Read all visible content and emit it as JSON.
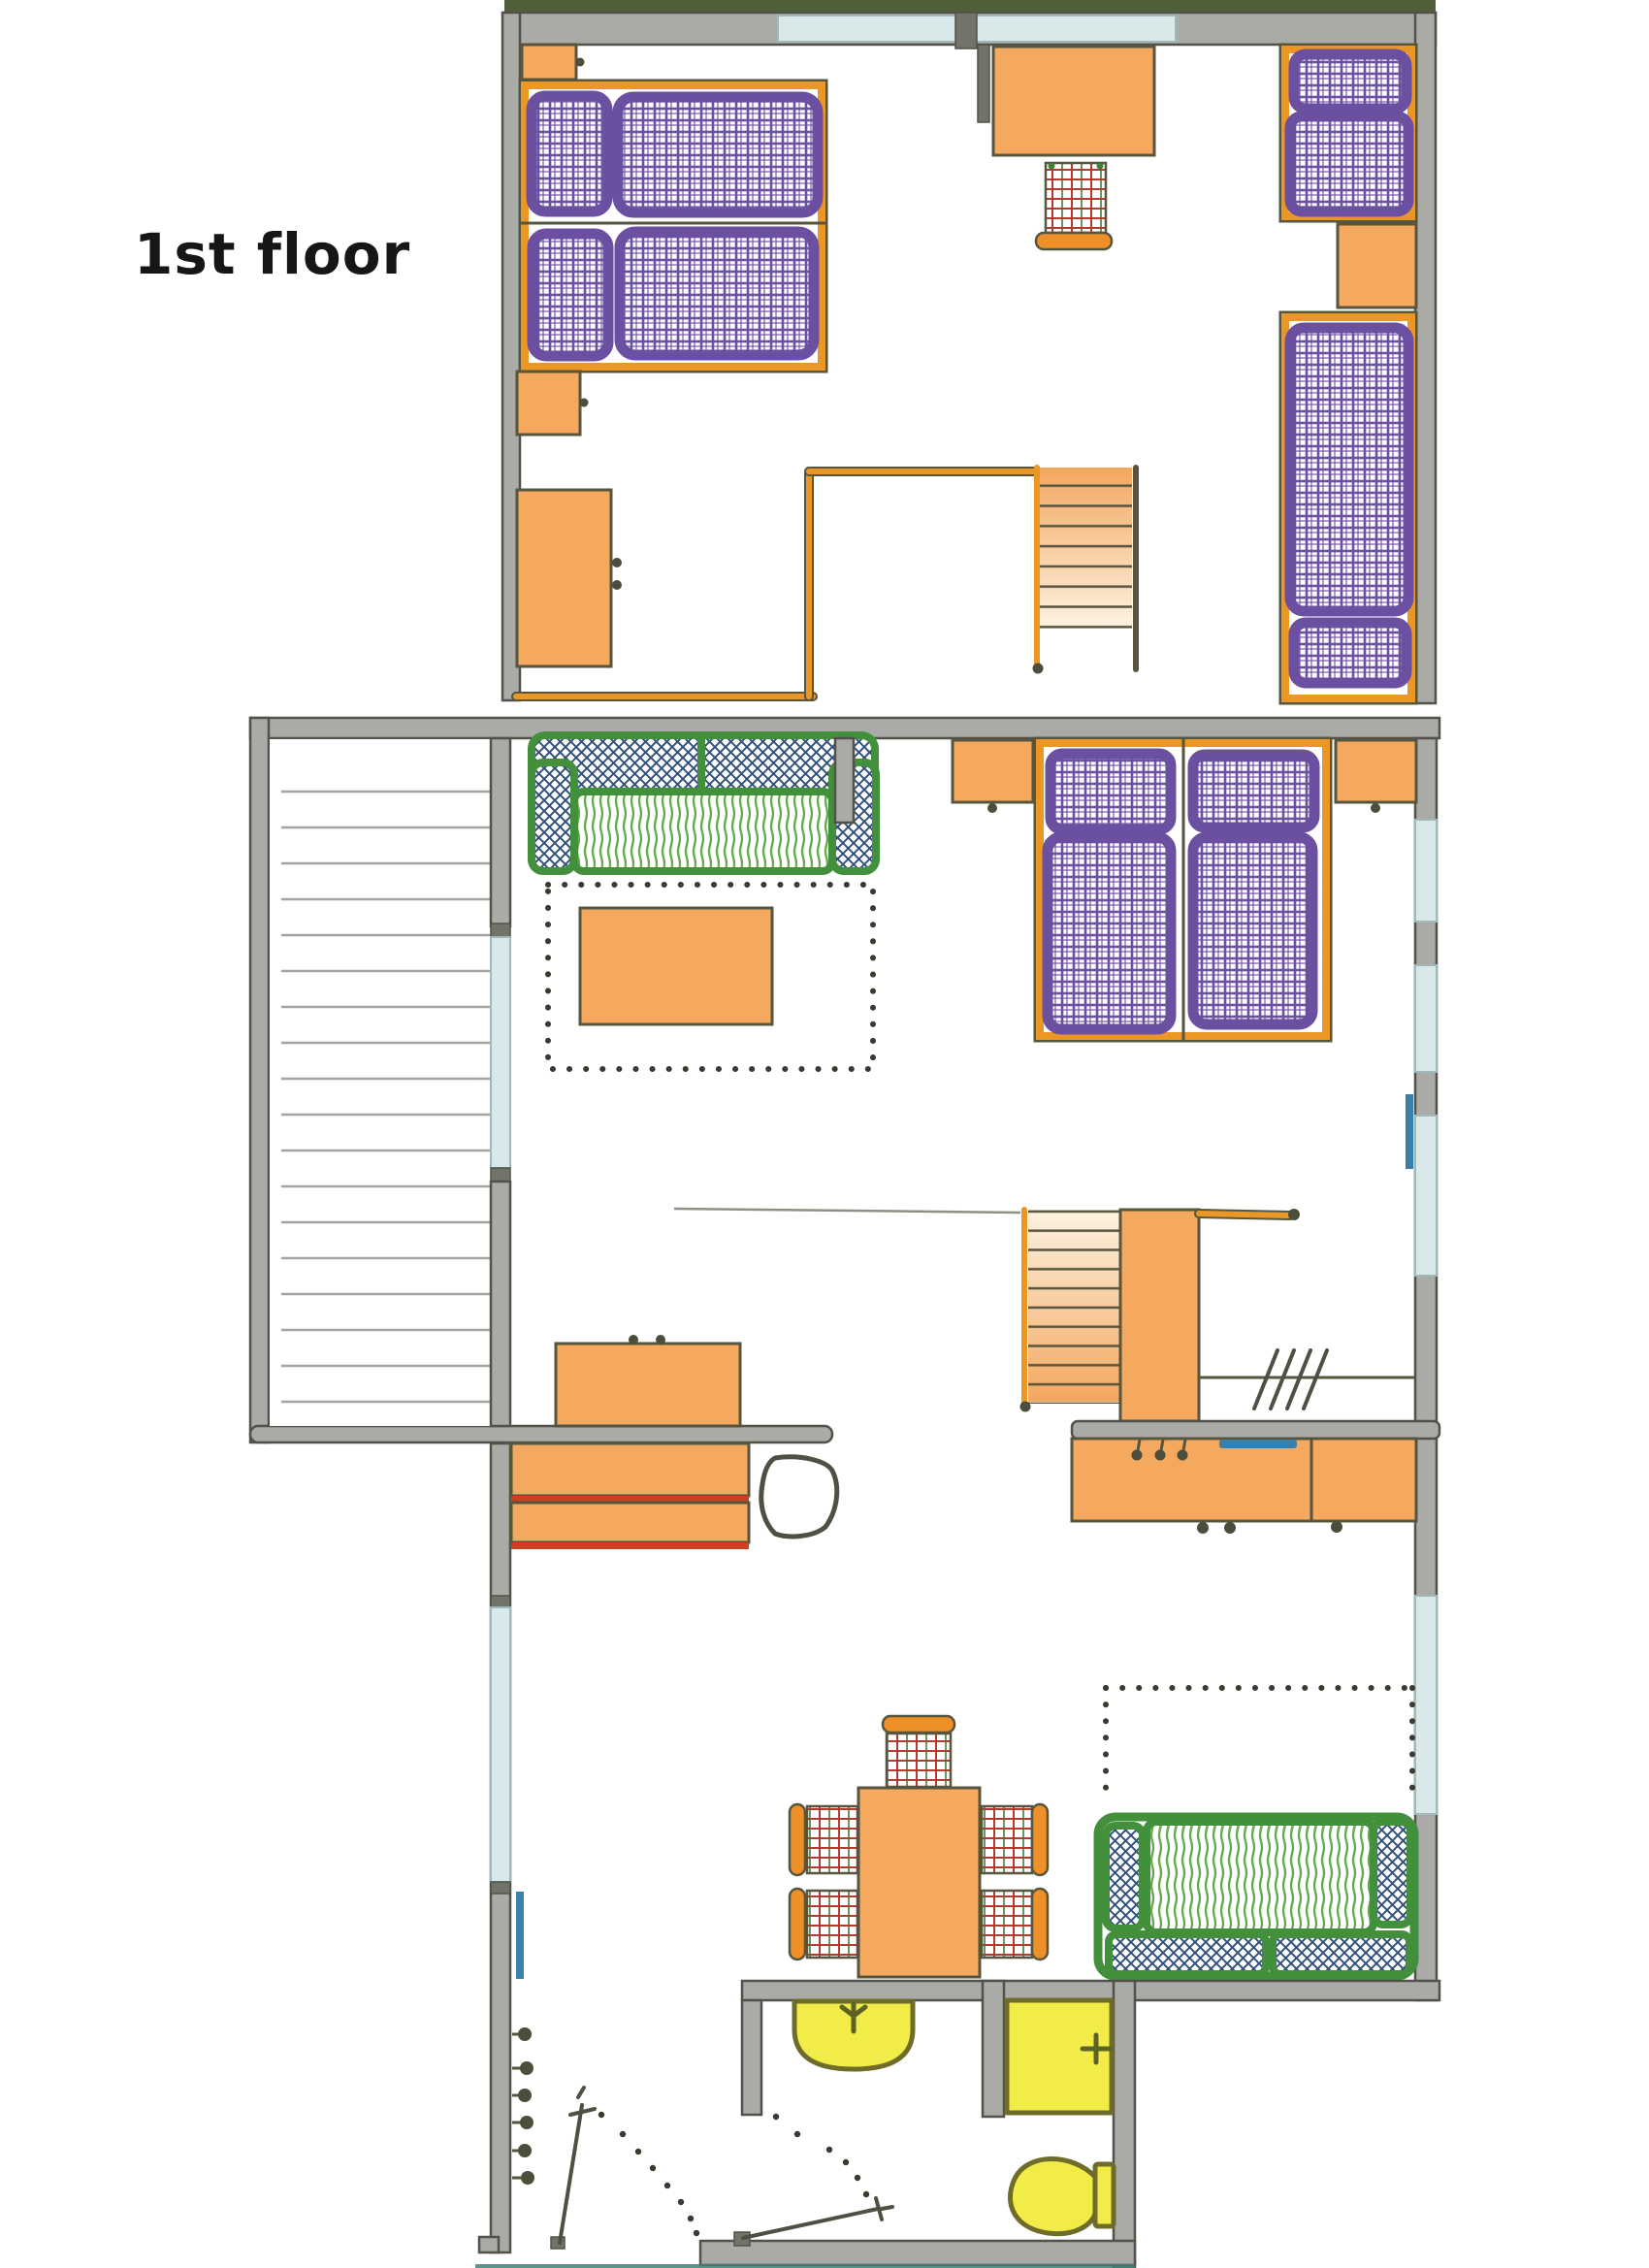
{
  "title": "1st floor",
  "palette": {
    "paper": "#ffffff",
    "ink": "#161616",
    "wall-fill": "#aaaaa6",
    "wall-edge": "#52524a",
    "roof-green": "#4e5f3a",
    "glass": "#d9e8e9",
    "glass-edge": "#9fb9ba",
    "accent-blue": "#3a7fa8",
    "furniture-orange": "#f4a95f",
    "furniture-orange-deep": "#ef8f28",
    "frame-orange": "#eb9726",
    "outline-olive": "#57553e",
    "mattress-purple": "#6b4fa0",
    "sofa-green": "#43903c",
    "seat-stroke-green": "#67ab51",
    "cushion-navy": "#32517c",
    "plaid-red": "#b23b2e",
    "plaid-green": "#3e7e3c",
    "bath-yellow": "#f2ec49",
    "bath-edge": "#6f6c2a",
    "desk-red": "#cc3f1f",
    "terrace-line": "#a3a39f",
    "stair-orange": "#f3a75f",
    "stair-pale": "#fdf3e2",
    "dot-ink": "#3a3a30",
    "teal-shadow": "#3f8076"
  },
  "floor_plans": {
    "attic": {
      "elements": [
        "roof-edge",
        "top-window",
        "cabinet-top-left",
        "bed-left-1",
        "bed-left-2",
        "cabinet-left",
        "wardrobe-left",
        "partition-rail",
        "staircase-attic",
        "table-attic",
        "chair-attic",
        "bed-right-1",
        "nightstand-attic",
        "bed-right-2"
      ]
    },
    "main": {
      "elements": [
        "terrace",
        "terrace-glass-partition",
        "sofa-living",
        "rug-living",
        "coffee-table",
        "nightstand-left",
        "double-bed",
        "nightstand-right",
        "window-wall-right",
        "staircase-main",
        "wardrobe-hall",
        "stair-railing",
        "radiator-line",
        "kitchen-counter",
        "kitchen-sink",
        "office-cabinet",
        "desk",
        "desk-chair",
        "dining-table",
        "dining-chairs",
        "rug-daybed",
        "sofa-daybed",
        "bathroom-sink",
        "shower",
        "toilet",
        "bathroom-door",
        "entry-door",
        "coat-hooks",
        "radiator-entry",
        "radiator-window"
      ]
    }
  }
}
